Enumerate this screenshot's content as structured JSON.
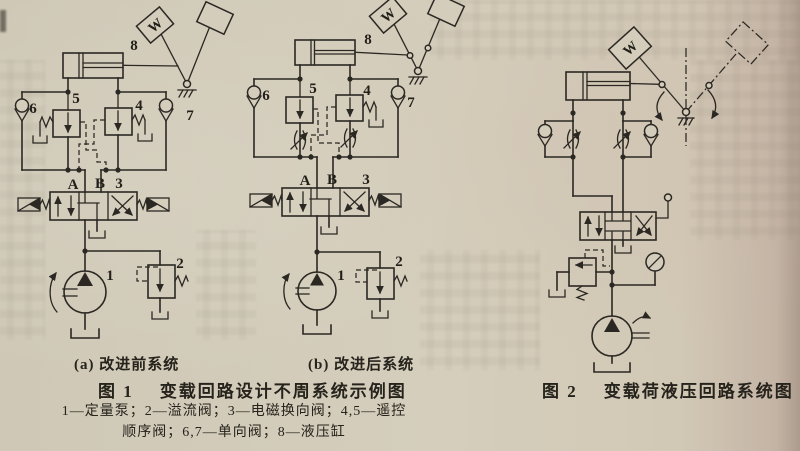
{
  "figure1": {
    "subfigure_a_label": "(a) 改进前系统",
    "subfigure_b_label": "(b) 改进后系统",
    "caption_label": "图 1",
    "caption_title": "变载回路设计不周系统示例图",
    "legend_line1": "1—定量泵；2—溢流阀；3—电磁换向阀；4,5—遥控",
    "legend_line2": "顺序阀；6,7—单向阀；8—液压缸"
  },
  "figure2": {
    "caption_label": "图 2",
    "caption_title": "变载荷液压回路系统图"
  },
  "labels": {
    "pump": "1",
    "relief_valve": "2",
    "directional_valve": "3",
    "seq_valve_right": "4",
    "seq_valve_left": "5",
    "check_valve_left": "6",
    "check_valve_right": "7",
    "cylinder": "8",
    "port_a": "A",
    "port_b": "B",
    "weight": "W"
  },
  "colors": {
    "paper": "#d4cdbc",
    "ink": "#2b2823"
  }
}
